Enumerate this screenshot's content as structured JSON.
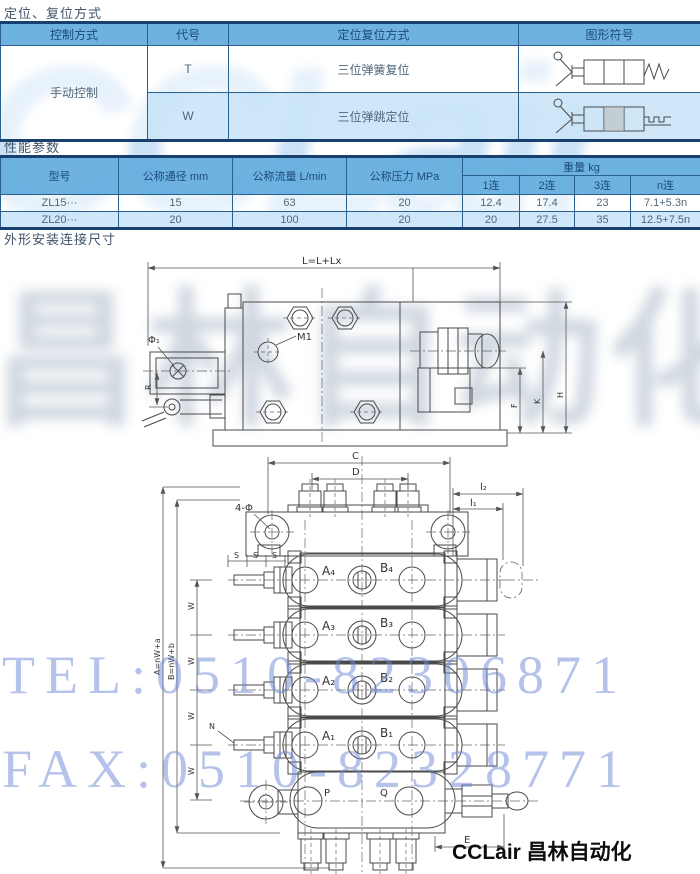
{
  "sections": {
    "s1_title": "定位、复位方式",
    "s2_title": "性能参数",
    "s3_title": "外形安装连接尺寸"
  },
  "control_table": {
    "headers": [
      "控制方式",
      "代号",
      "定位复位方式",
      "图形符号"
    ],
    "control_method": "手动控制",
    "rows": [
      {
        "code": "T",
        "method": "三位弹簧复位",
        "symbol": "manual-lever-3pos-spring-return"
      },
      {
        "code": "W",
        "method": "三位弹跳定位",
        "symbol": "manual-lever-3pos-detent"
      }
    ]
  },
  "perf_table": {
    "headers": {
      "model": "型号",
      "diameter": "公称通径 mm",
      "flow": "公称流量 L/min",
      "pressure": "公称压力 MPa",
      "weight": "重量 kg",
      "weight_subs": [
        "1连",
        "2连",
        "3连",
        "n连"
      ]
    },
    "rows": [
      {
        "model": "ZL15···",
        "diameter": "15",
        "flow": "63",
        "pressure": "20",
        "w1": "12.4",
        "w2": "17.4",
        "w3": "23",
        "wn": "7.1+5.3n"
      },
      {
        "model": "ZL20···",
        "diameter": "20",
        "flow": "100",
        "pressure": "20",
        "w1": "20",
        "w2": "27.5",
        "w3": "35",
        "wn": "12.5+7.5n"
      }
    ]
  },
  "drawing1": {
    "labels": {
      "dim_length": "L=L+Lx",
      "m1": "M1",
      "phi1": "Φ₁",
      "r": "R",
      "f": "F",
      "k": "K",
      "h": "H"
    }
  },
  "drawing2": {
    "labels": {
      "c": "C",
      "d": "D",
      "four_phi": "4-Φ",
      "l2": "l₂",
      "l1": "l₁",
      "s": "S",
      "w": "W",
      "a_eq": "A=nW+a",
      "b_eq": "B=nW+b",
      "n": "N",
      "a4": "A₄",
      "b4": "B₄",
      "a3": "A₃",
      "b3": "B₃",
      "a2": "A₂",
      "b2": "B₂",
      "a1": "A₁",
      "b1": "B₁",
      "p": "P",
      "q": "Q",
      "e": "E"
    }
  },
  "watermark": {
    "brand": "CCLair",
    "brand_cn": "昌林自动化",
    "tel": "TEL:0510-82306871",
    "fax": "FAX:0510-82328771"
  },
  "footer": {
    "brand": "CCLair 昌林自动化"
  },
  "colors": {
    "header_bg": "#63ADDE",
    "row_alt_bg": "#CBE5F7",
    "table_border": "#2A608F",
    "outer_border": "#17406E",
    "header_text": "#1A4A7D",
    "body_text": "#51677A",
    "watermark_blue": "#6C86D6",
    "drawing_stroke": "#4A4A4A"
  }
}
